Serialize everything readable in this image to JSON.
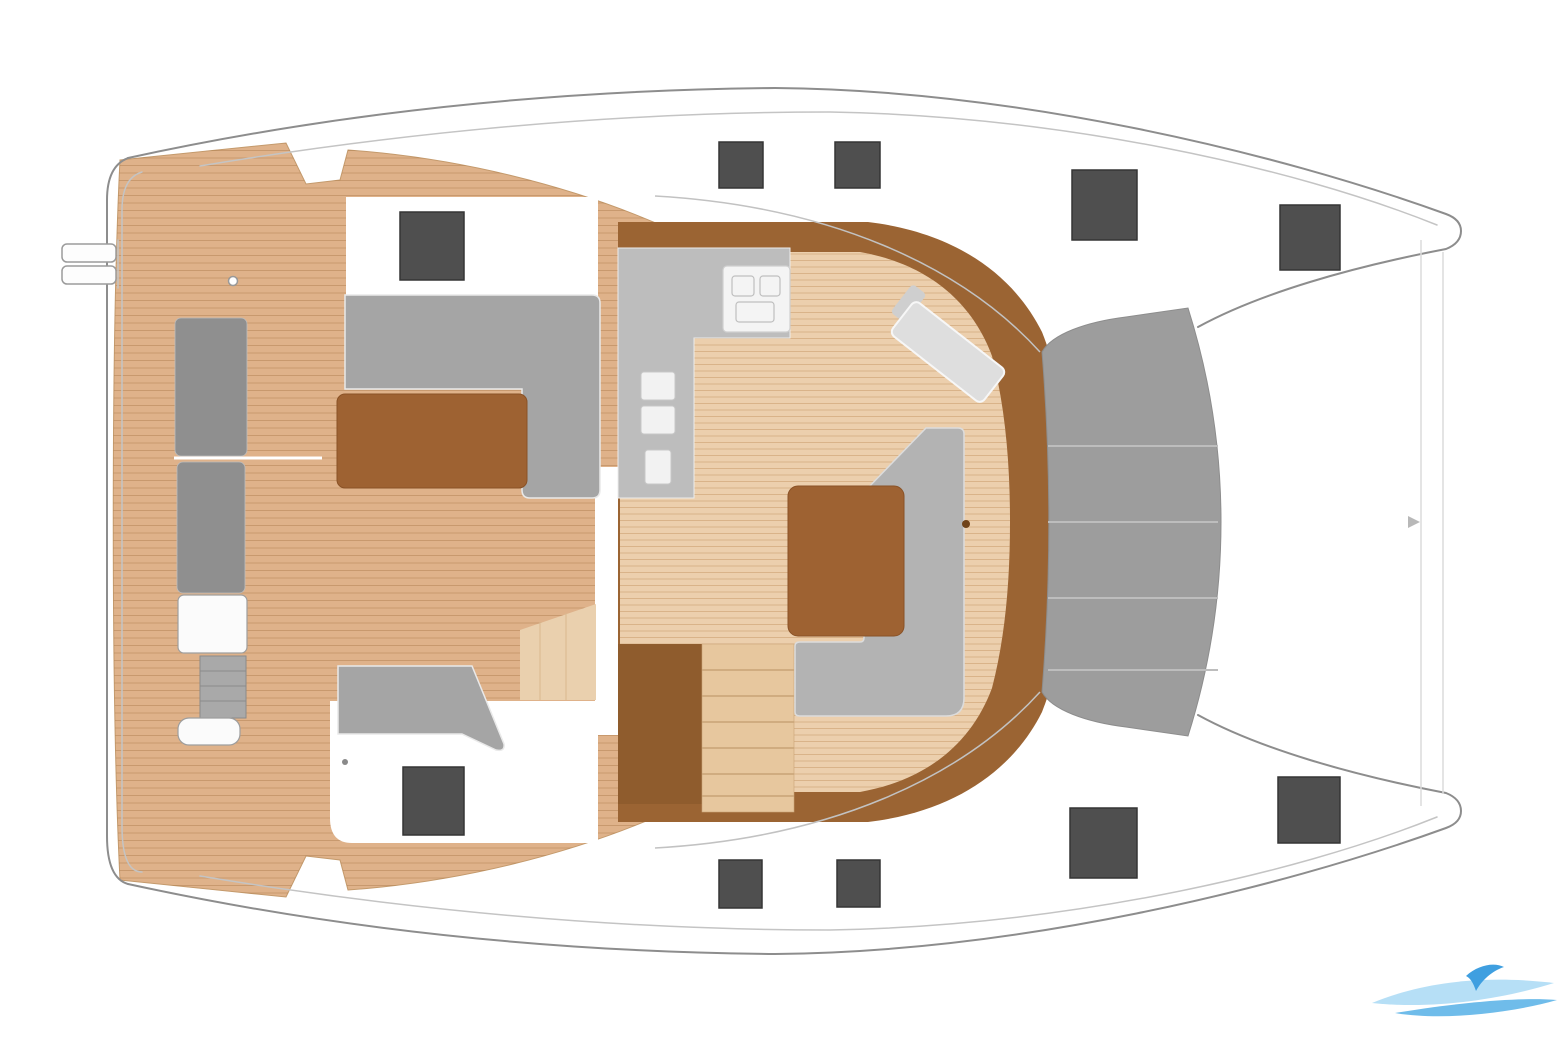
{
  "diagram": {
    "type": "catamaran-deck-plan",
    "view": "top-down floor plan",
    "orientation": "bow-right-stern-left",
    "regions": [
      {
        "id": "swim-ladder",
        "label": "stern ladder"
      },
      {
        "id": "aft-platform",
        "label": "teak aft platform"
      },
      {
        "id": "cockpit",
        "label": "aft cockpit with benches and table"
      },
      {
        "id": "cockpit-sofa",
        "label": "L-shaped cockpit sofa"
      },
      {
        "id": "cockpit-table",
        "label": "cockpit table"
      },
      {
        "id": "transom-bench",
        "label": "transom bench seats"
      },
      {
        "id": "transom-steps",
        "label": "transom steps"
      },
      {
        "id": "saloon",
        "label": "saloon"
      },
      {
        "id": "galley",
        "label": "galley counter with sink and stove"
      },
      {
        "id": "nav-bench",
        "label": "forward facing seat"
      },
      {
        "id": "saloon-sofa",
        "label": "saloon sofa"
      },
      {
        "id": "saloon-table",
        "label": "saloon dining table"
      },
      {
        "id": "companionway-stairs",
        "label": "companionway stairs"
      },
      {
        "id": "foredeck",
        "label": "foredeck"
      },
      {
        "id": "trampoline",
        "label": "bow trampoline"
      },
      {
        "id": "bows",
        "label": "twin hull bows"
      }
    ],
    "hatch_count": 10,
    "watermark_present": true
  },
  "colors": {
    "hull_line": "#8d8d8d",
    "hull_line_light": "#c4c4c4",
    "wood": "#dfb28a",
    "wood_edge": "#c49a6c",
    "wood_light": "#ead0ae",
    "saloon_ring": "#9b6433",
    "saloon_floor": "#eccfad",
    "cabinet": "#8f5c2d",
    "counter": "#bdbdbd",
    "bench_dark": "#8f8f8f",
    "bench_mid": "#a5a5a5",
    "bench_light": "#dedede",
    "seat_gray": "#b3b3b3",
    "table_brown": "#9e6232",
    "trampoline": "#9d9d9d",
    "trampoline_seam": "#bdbdbd",
    "hatch": "#4f4f4f",
    "hatch_edge": "#353535",
    "watermark_light": "#a9d9f5",
    "watermark_mid": "#5fb5e8",
    "watermark_dark": "#3f9fe0"
  },
  "hatches": [
    {
      "id": "aft-coachroof-port",
      "x": 400,
      "y": 212,
      "w": 64,
      "h": 68
    },
    {
      "id": "sidedeck-port-1",
      "x": 719,
      "y": 142,
      "w": 44,
      "h": 46
    },
    {
      "id": "sidedeck-port-2",
      "x": 835,
      "y": 142,
      "w": 45,
      "h": 46
    },
    {
      "id": "foredeck-port",
      "x": 1072,
      "y": 170,
      "w": 65,
      "h": 70
    },
    {
      "id": "bow-port",
      "x": 1280,
      "y": 205,
      "w": 60,
      "h": 65
    },
    {
      "id": "aft-coachroof-stbd",
      "x": 403,
      "y": 767,
      "w": 61,
      "h": 68
    },
    {
      "id": "sidedeck-stbd-1",
      "x": 719,
      "y": 860,
      "w": 43,
      "h": 48
    },
    {
      "id": "sidedeck-stbd-2",
      "x": 837,
      "y": 860,
      "w": 43,
      "h": 47
    },
    {
      "id": "foredeck-stbd",
      "x": 1070,
      "y": 808,
      "w": 67,
      "h": 70
    },
    {
      "id": "bow-stbd",
      "x": 1278,
      "y": 777,
      "w": 62,
      "h": 66
    }
  ],
  "trampoline": {
    "seam_y": [
      446,
      522,
      598,
      670
    ]
  },
  "stairs": {
    "tread_y": [
      670,
      696,
      722,
      748,
      774,
      796
    ]
  }
}
